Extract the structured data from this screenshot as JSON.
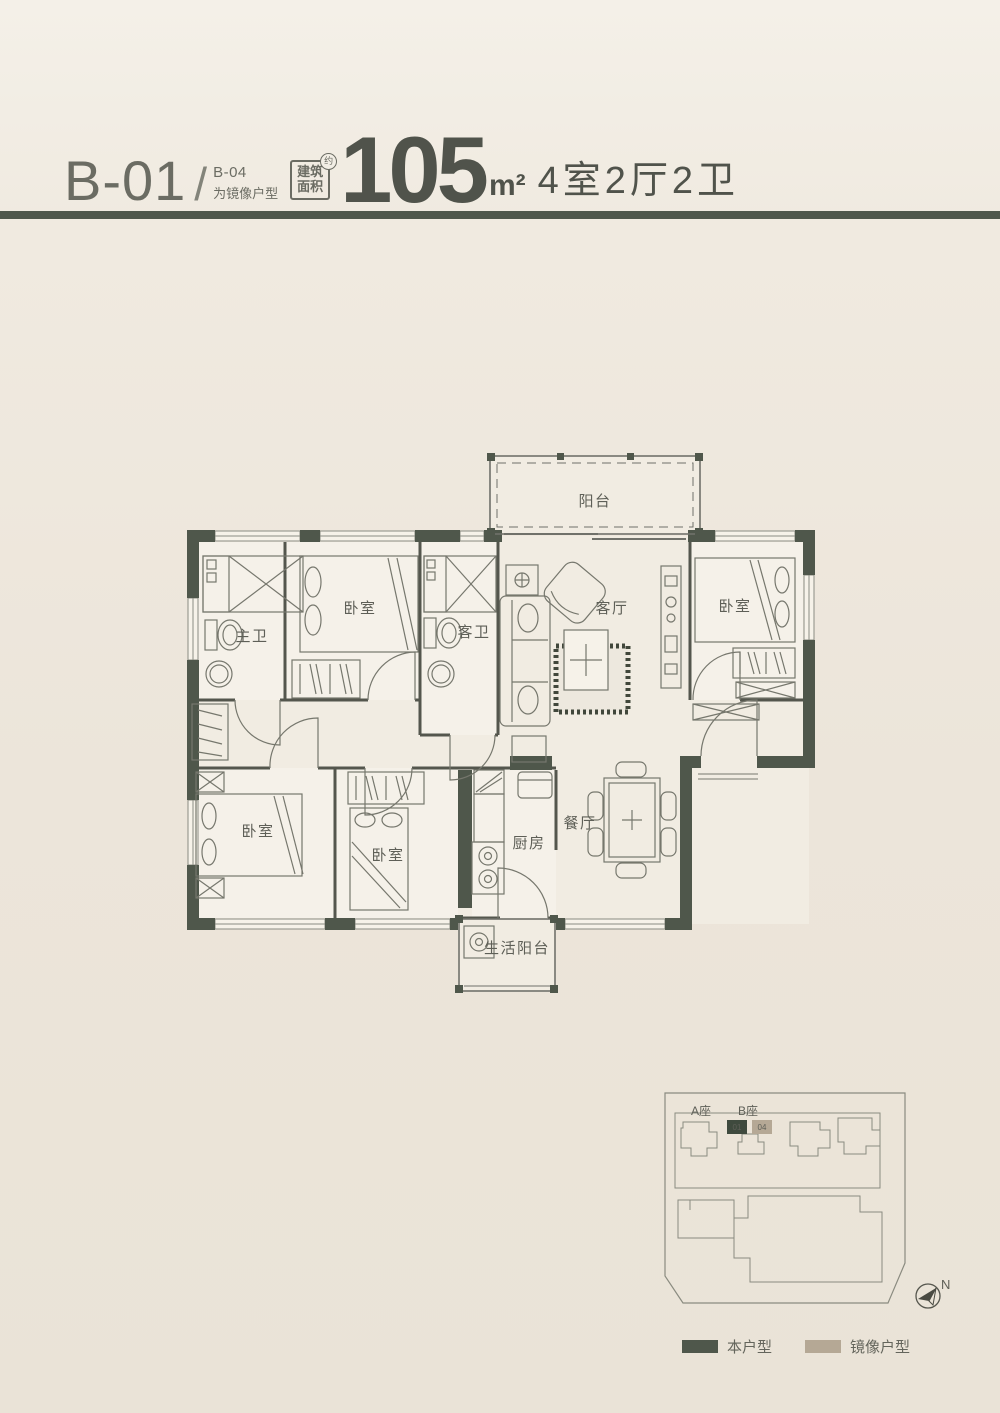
{
  "header": {
    "unit_code": "B-01",
    "slash": "/",
    "mirror_code": "B-04",
    "mirror_note": "为镜像户型",
    "area_box": {
      "line1": "建筑",
      "line2": "面积",
      "approx": "约"
    },
    "area_value": "105",
    "area_unit": "m²",
    "layout_spec": "4室2厅2卫"
  },
  "plan": {
    "rooms": {
      "balcony": "阳台",
      "living": "客厅",
      "bedroom": "卧室",
      "master_bath": "主卫",
      "guest_bath": "客卫",
      "kitchen": "厨房",
      "dining": "餐厅",
      "service_balcony": "生活阳台"
    }
  },
  "siteplan": {
    "tower_a": "A座",
    "tower_b": "B座",
    "unit_this": "01",
    "unit_mirror": "04",
    "north": "N"
  },
  "legend": {
    "this_label": "本户型",
    "mirror_label": "镜像户型"
  },
  "colors": {
    "page_bg": "#ECE5DA",
    "divider": "#4F574B",
    "wall": "#4F574B",
    "this_unit_green": "#3F4A3E",
    "mirror_beige": "#B5A895",
    "plan_line": "#76776D",
    "room_floor": "#F5F1E9"
  }
}
